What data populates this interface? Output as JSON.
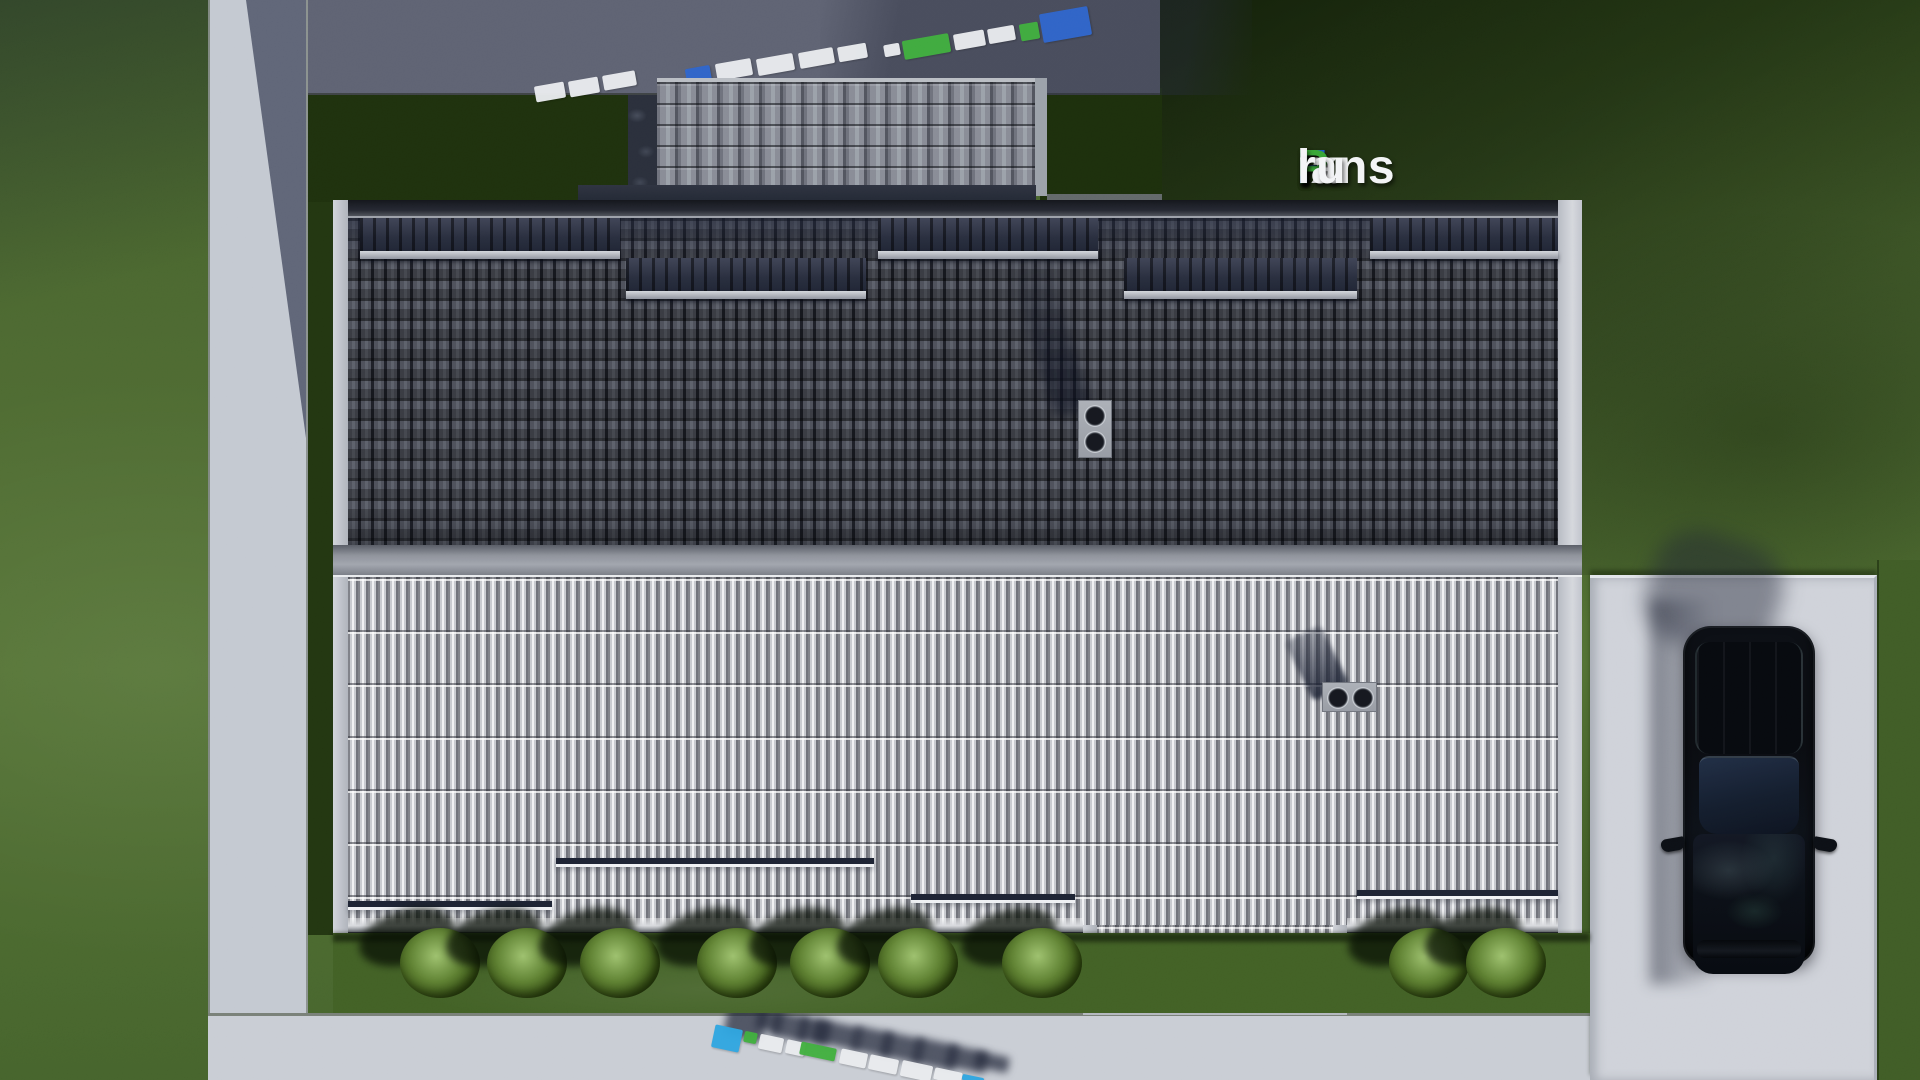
{
  "brand": {
    "full_text": "FixPlans.ru",
    "parts": [
      {
        "text": "F",
        "color": "#1e5fd0"
      },
      {
        "text": "ix",
        "color": "#f3f4f6"
      },
      {
        "text": "P",
        "color": "#3aa838"
      },
      {
        "text": "lans",
        "color": "#f3f4f6"
      },
      {
        "text": ".",
        "color": "#2e6fd8"
      },
      {
        "text": "ru",
        "color": "#f3f4f6"
      }
    ]
  },
  "colors": {
    "grass": "#4a672e",
    "grass_shadow": "#1c2e0c",
    "concrete_bright": "#c8ccd3",
    "concrete_shadow": "#5c6070",
    "roof_dark_tile": "#4b4e58",
    "roof_light_tile": "#c7c9ce",
    "ridge": "#8d9199",
    "snow_patch": "#262b3b",
    "guard_rail_dark": "#1b2130",
    "car_body": "#0a0d12",
    "watermark_white": "#e9ebee",
    "watermark_blue": "#2c63cb",
    "watermark_cyan": "#2ba4e0",
    "watermark_green": "#3dad3b"
  },
  "scene": {
    "bushes": {
      "y": 965,
      "x": [
        440,
        527,
        620,
        737,
        830,
        918,
        1042,
        1429,
        1506
      ]
    },
    "roof": {
      "dark_tile_patches": [
        {
          "x": 360,
          "w": 260,
          "level": "upper"
        },
        {
          "x": 626,
          "w": 240,
          "level": "lower"
        },
        {
          "x": 878,
          "w": 220,
          "level": "upper"
        },
        {
          "x": 1124,
          "w": 233,
          "level": "lower"
        },
        {
          "x": 1370,
          "w": 188,
          "level": "upper"
        }
      ],
      "light_roof_guards": [
        {
          "x": 348,
          "y": 901,
          "w": 204
        },
        {
          "x": 556,
          "y": 858,
          "w": 318
        },
        {
          "x": 911,
          "y": 894,
          "w": 164
        },
        {
          "x": 1357,
          "y": 890,
          "w": 201
        },
        {
          "x": 1115,
          "y": 958,
          "w": 202
        }
      ]
    },
    "watermark_top": {
      "tilt_deg": -10,
      "blocks": [
        [
          535,
          84,
          30,
          16,
          "w"
        ],
        [
          569,
          79,
          30,
          16,
          "w"
        ],
        [
          603,
          73,
          33,
          15,
          "w"
        ],
        [
          686,
          67,
          25,
          17,
          "b"
        ],
        [
          716,
          61,
          36,
          17,
          "w"
        ],
        [
          757,
          56,
          37,
          17,
          "w"
        ],
        [
          799,
          50,
          35,
          16,
          "w"
        ],
        [
          838,
          45,
          29,
          15,
          "w"
        ],
        [
          884,
          44,
          16,
          12,
          "w"
        ],
        [
          903,
          37,
          47,
          19,
          "g"
        ],
        [
          954,
          32,
          31,
          16,
          "w"
        ],
        [
          988,
          27,
          27,
          15,
          "w"
        ],
        [
          1020,
          23,
          19,
          17,
          "g"
        ],
        [
          1041,
          10,
          49,
          29,
          "b"
        ]
      ]
    },
    "watermark_bottom": {
      "tilt_deg": 12,
      "blocks": [
        [
          713,
          1027,
          28,
          23,
          "b"
        ],
        [
          744,
          1032,
          13,
          11,
          "g"
        ],
        [
          759,
          1036,
          24,
          15,
          "w"
        ],
        [
          786,
          1041,
          19,
          14,
          "w"
        ],
        [
          800,
          1045,
          36,
          13,
          "g"
        ],
        [
          840,
          1051,
          27,
          15,
          "w"
        ],
        [
          869,
          1057,
          29,
          15,
          "w"
        ],
        [
          901,
          1063,
          31,
          16,
          "w"
        ],
        [
          934,
          1070,
          28,
          12,
          "w"
        ],
        [
          962,
          1076,
          22,
          6,
          "b"
        ]
      ]
    }
  }
}
